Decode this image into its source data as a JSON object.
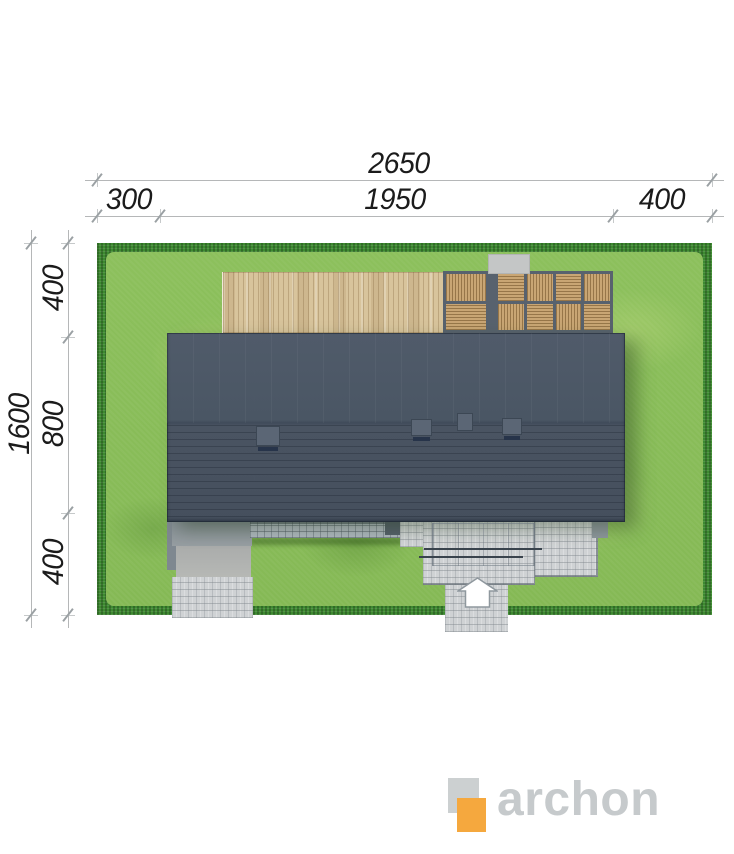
{
  "dimensions": {
    "top": {
      "total": "2650",
      "left": "300",
      "middle": "1950",
      "right": "400"
    },
    "side": {
      "total": "1600",
      "top": "400",
      "middle": "800",
      "bottom": "400"
    }
  },
  "logo": {
    "wordmark": "archon"
  },
  "colors": {
    "roof": "#495462",
    "lawn": "#8cc05c",
    "hedge": "#3e8a31",
    "deck_wood": "#d8c49c",
    "pergola_wood": "#c9a674",
    "paving": "#cfd2d4",
    "logo_orange": "#f5a83e",
    "logo_gray": "#c6cacc",
    "dimension_text": "#1b1b1b"
  },
  "icons": {
    "entrance_arrow": "up-arrow-entrance-icon",
    "logo_mark": "archon-overlapping-squares-icon"
  }
}
